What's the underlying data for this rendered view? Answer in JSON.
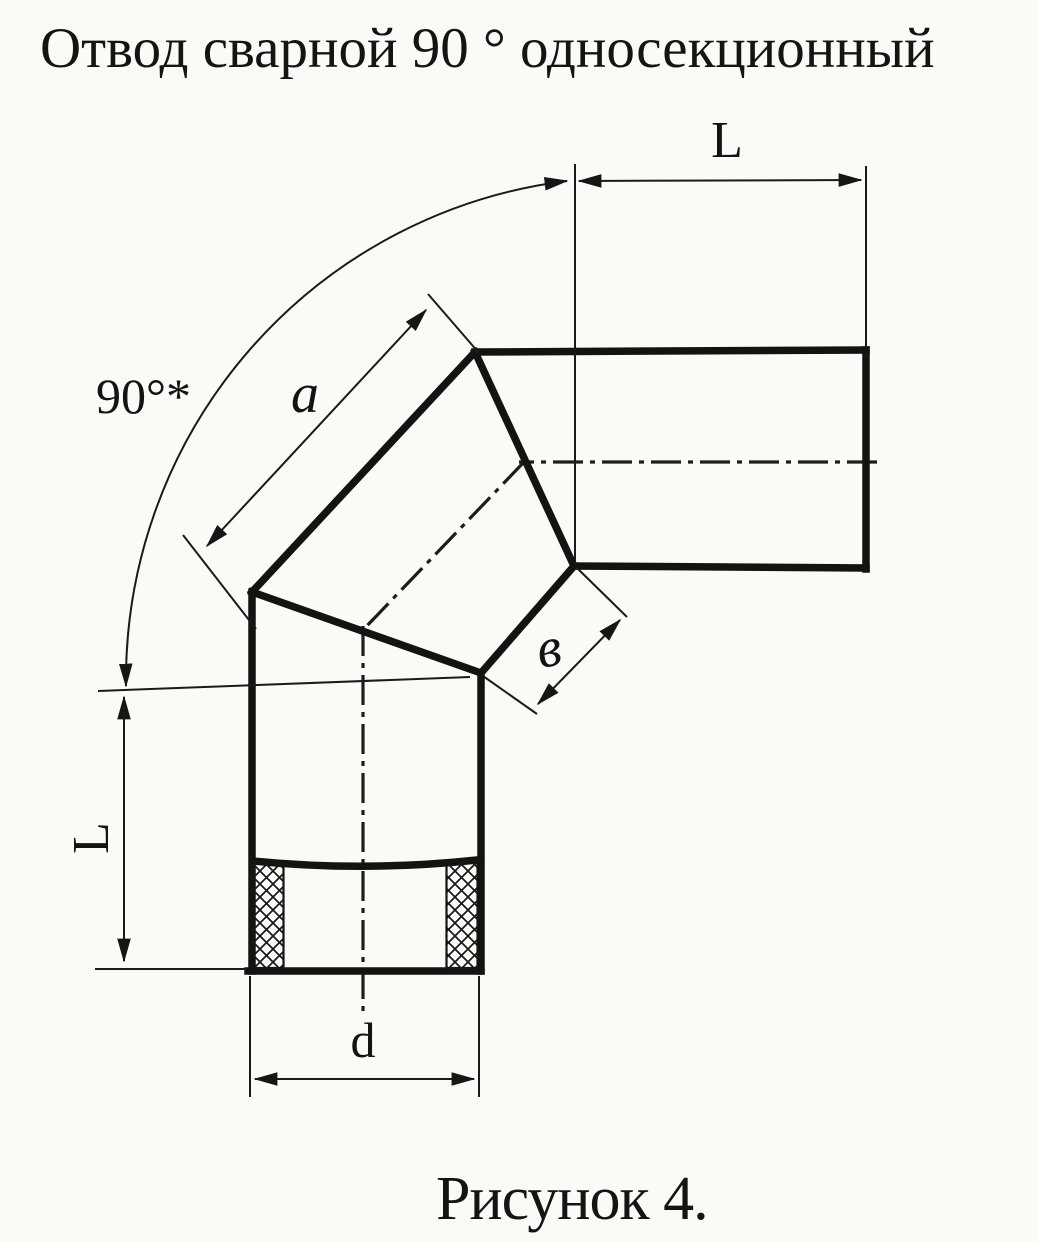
{
  "title": "Отвод сварной 90 ° односекционный",
  "caption": "Рисунок 4.",
  "colors": {
    "ink": "#141414",
    "paper": "#fafaf7"
  },
  "drawing": {
    "kind": "technical drawing, welded 90-degree one-section pipe elbow, front view with section",
    "labels": {
      "angle": "90°*",
      "section_side": "a",
      "inner_side": "в",
      "leg_top": "L",
      "leg_left": "L",
      "diameter": "d"
    }
  }
}
